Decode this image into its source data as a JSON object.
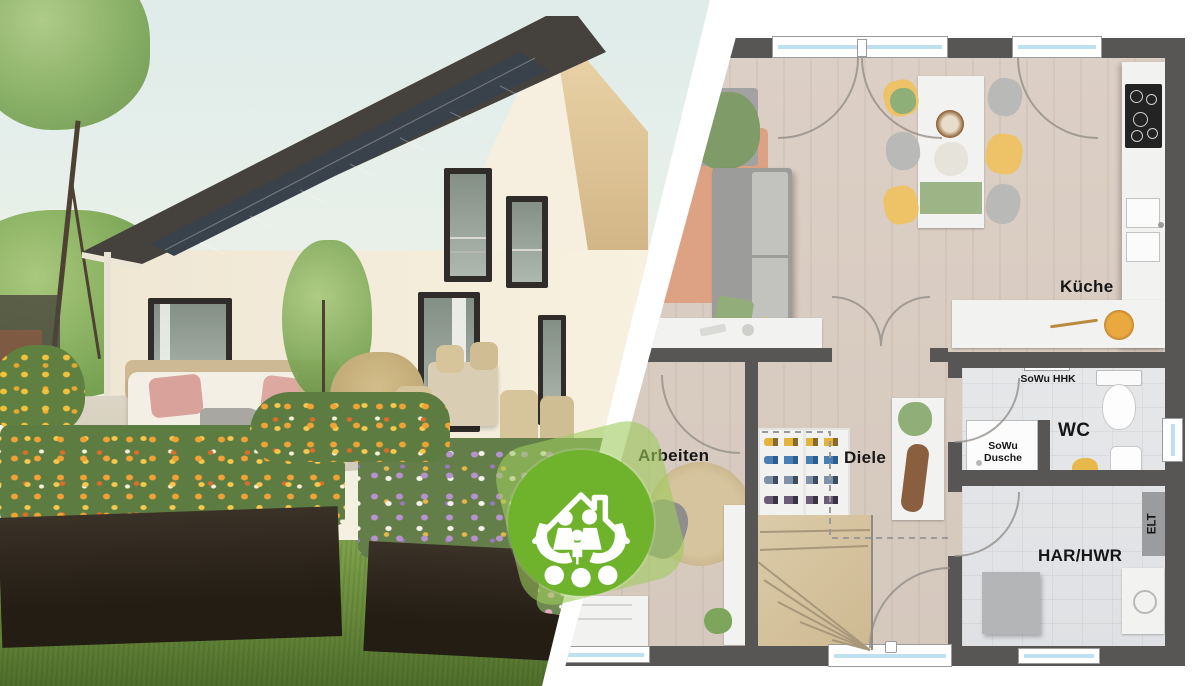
{
  "badge": {
    "icon": "house-family-in-hands-icon",
    "green": "#6FB32C",
    "halo_green": "rgba(158,203,94,0.6)"
  },
  "plan": {
    "labels": {
      "kueche": "Küche",
      "wc": "WC",
      "har_hwr": "HAR/HWR",
      "arbeiten": "Arbeiten",
      "diele": "Diele",
      "sowu_hhk": "SoWu HHK",
      "sowu_dusche": "SoWu Dusche",
      "elt": "ELT"
    },
    "colors": {
      "wall": "#575655",
      "wood_floor": "#D8CCC2",
      "tile_floor": "#E2E4E6",
      "window_glass": "#BFE0EE",
      "stair_wood": "#D6C5A5",
      "chair_yellow": "#EEC266",
      "cushion_green": "#8FAD7C",
      "rug_salmon": "#DD9F7F"
    }
  },
  "photo": {
    "colors": {
      "sky": "#E4EFEC",
      "house_wall": "#F5EEDD",
      "roof": "#45413C",
      "solar_panel": "#39414B",
      "gable_wood": "#DFC79D",
      "lawn_green": "#6E923F",
      "flower_orange": "#EE9D33",
      "flower_purple": "#B693CF",
      "flower_pink": "#E5A9C6",
      "planter_dark": "#2E261D",
      "pillow_pink": "#D9A29B"
    }
  }
}
